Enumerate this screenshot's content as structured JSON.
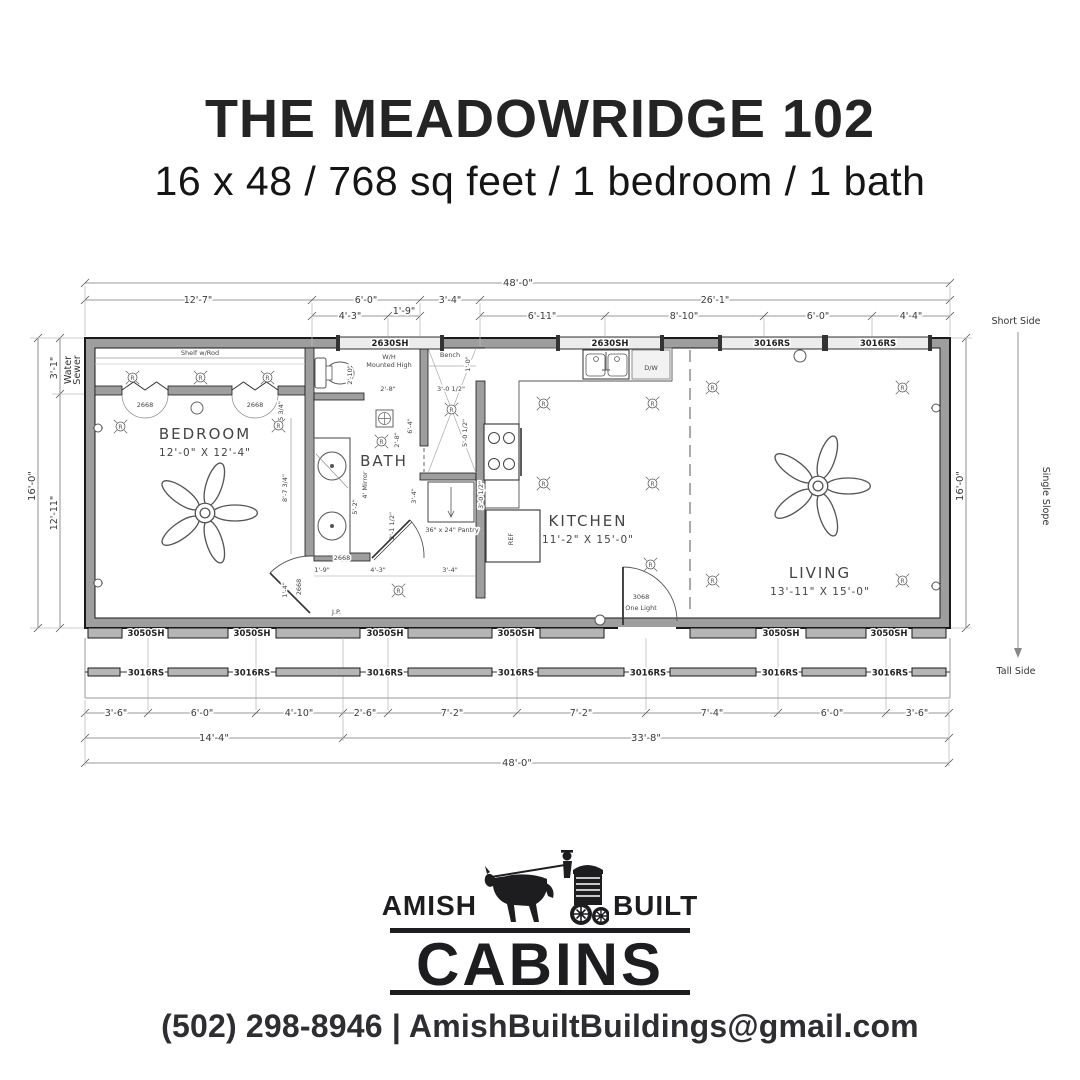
{
  "header": {
    "title": "THE MEADOWRIDGE 102",
    "subtitle": "16 x 48 / 768 sq feet / 1 bedroom / 1 bath"
  },
  "plan": {
    "rooms": {
      "bedroom": {
        "name": "BEDROOM",
        "size": "12'-0\" X 12'-4\""
      },
      "bath": {
        "name": "BATH"
      },
      "kitchen": {
        "name": "KITCHEN",
        "size": "11'-2\" X 15'-0\""
      },
      "living": {
        "name": "LIVING",
        "size": "13'-11\" X 15'-0\""
      }
    },
    "dims_top": {
      "overall": "48'-0\"",
      "row1": [
        "12'-7\"",
        "6'-0\"",
        "3'-4\"",
        "26'-1\""
      ],
      "row2": [
        "4'-3\"",
        "1'-9\"",
        "6'-11\"",
        "8'-10\"",
        "6'-0\"",
        "4'-4\""
      ]
    },
    "dims_bottom": {
      "row1": [
        "3'-6\"",
        "6'-0\"",
        "4'-10\"",
        "2'-6\"",
        "7'-2\"",
        "7'-2\"",
        "7'-4\"",
        "6'-0\"",
        "3'-6\""
      ],
      "row2": [
        "14'-4\"",
        "33'-8\""
      ],
      "overall": "48'-0\""
    },
    "dims_left": {
      "overall": "16'-0\"",
      "top": "3'-1\"",
      "bottom": "12'-11\"",
      "note1": "Water",
      "note2": "Sewer"
    },
    "dims_right": {
      "overall": "16'-0\""
    },
    "roof": {
      "short_side": "Short Side",
      "tall_side": "Tall Side",
      "slope": "Single Slope"
    },
    "windows": {
      "top": [
        "2630SH",
        "2630SH",
        "3016RS",
        "3016RS"
      ],
      "bottom": [
        "3050SH",
        "3050SH",
        "3050SH",
        "3050SH",
        "3050SH",
        "3050SH"
      ],
      "porch": [
        "3016RS",
        "3016RS",
        "3016RS",
        "3016RS",
        "3016RS",
        "3016RS",
        "3016RS"
      ]
    },
    "doors": {
      "entry": "3068",
      "entry_sub": "One Light",
      "closet_left": "2668",
      "closet_right": "2668",
      "bedroom": "2668",
      "bath": "2668"
    },
    "annotations": {
      "shelf": "Shelf w/Rod",
      "wh1": "W/H",
      "wh2": "Mounted High",
      "bench": "Bench",
      "mirror": "4' Mirror",
      "pantry": "36\" x 24\" Pantry",
      "dw": "D/W",
      "ref": "REF",
      "jp": "J.P."
    },
    "symbols": {
      "recessed": "R"
    },
    "small_dims": {
      "toilet": "2'-10\"",
      "bath_w": "2'-8\"",
      "bath_h": "6'-4\"",
      "bath_v": "2'-8\"",
      "bath_d": "3'-4\"",
      "shower_w": "3'-0 1/2\"",
      "shower_h": "5'-0 1/2\"",
      "bench_d": "1'-0\"",
      "vanity": "5'-2\"",
      "door_off": "2'-1 1/2\"",
      "hall_a": "1'-9\"",
      "hall_b": "4'-3\"",
      "hall_c": "3'-4\"",
      "pantry_d": "3'-0 1/2\"",
      "bed_a": "5 3/4\"",
      "bed_b": "8'-7 3/4\"",
      "bed_c": "1'-4\""
    }
  },
  "logo": {
    "amish": "AMISH",
    "built": "BUILT",
    "cabins": "CABINS"
  },
  "footer": {
    "contact": "(502) 298-8946 | AmishBuiltBuildings@gmail.com"
  }
}
